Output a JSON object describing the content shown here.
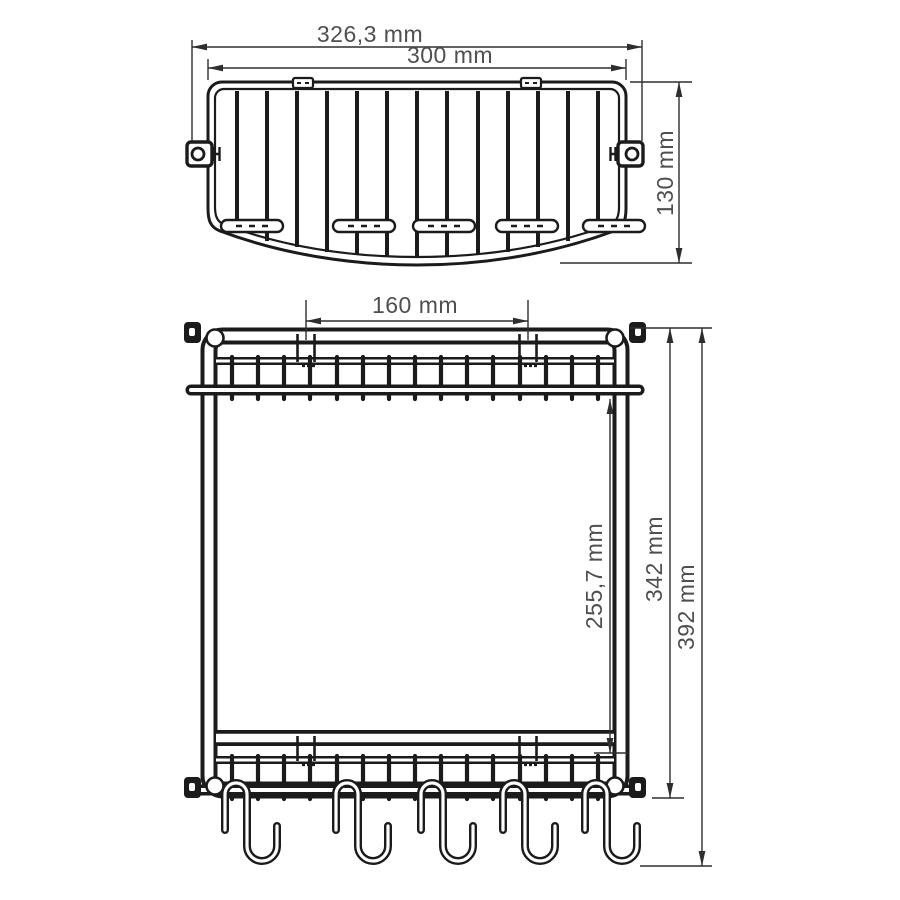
{
  "colors": {
    "background": "#ffffff",
    "object_line": "#1b1b1b",
    "dimension_line": "#2e2e2e",
    "dimension_text": "#4f4f4f"
  },
  "top_view": {
    "dim_overall_width": "326,3 mm",
    "dim_basket_width": "300 mm",
    "dim_depth": "130 mm"
  },
  "front_view": {
    "dim_mount_spacing": "160 mm",
    "dim_shelf_clearance": "255,7 mm",
    "dim_frame_height": "342 mm",
    "dim_total_height": "392 mm"
  }
}
